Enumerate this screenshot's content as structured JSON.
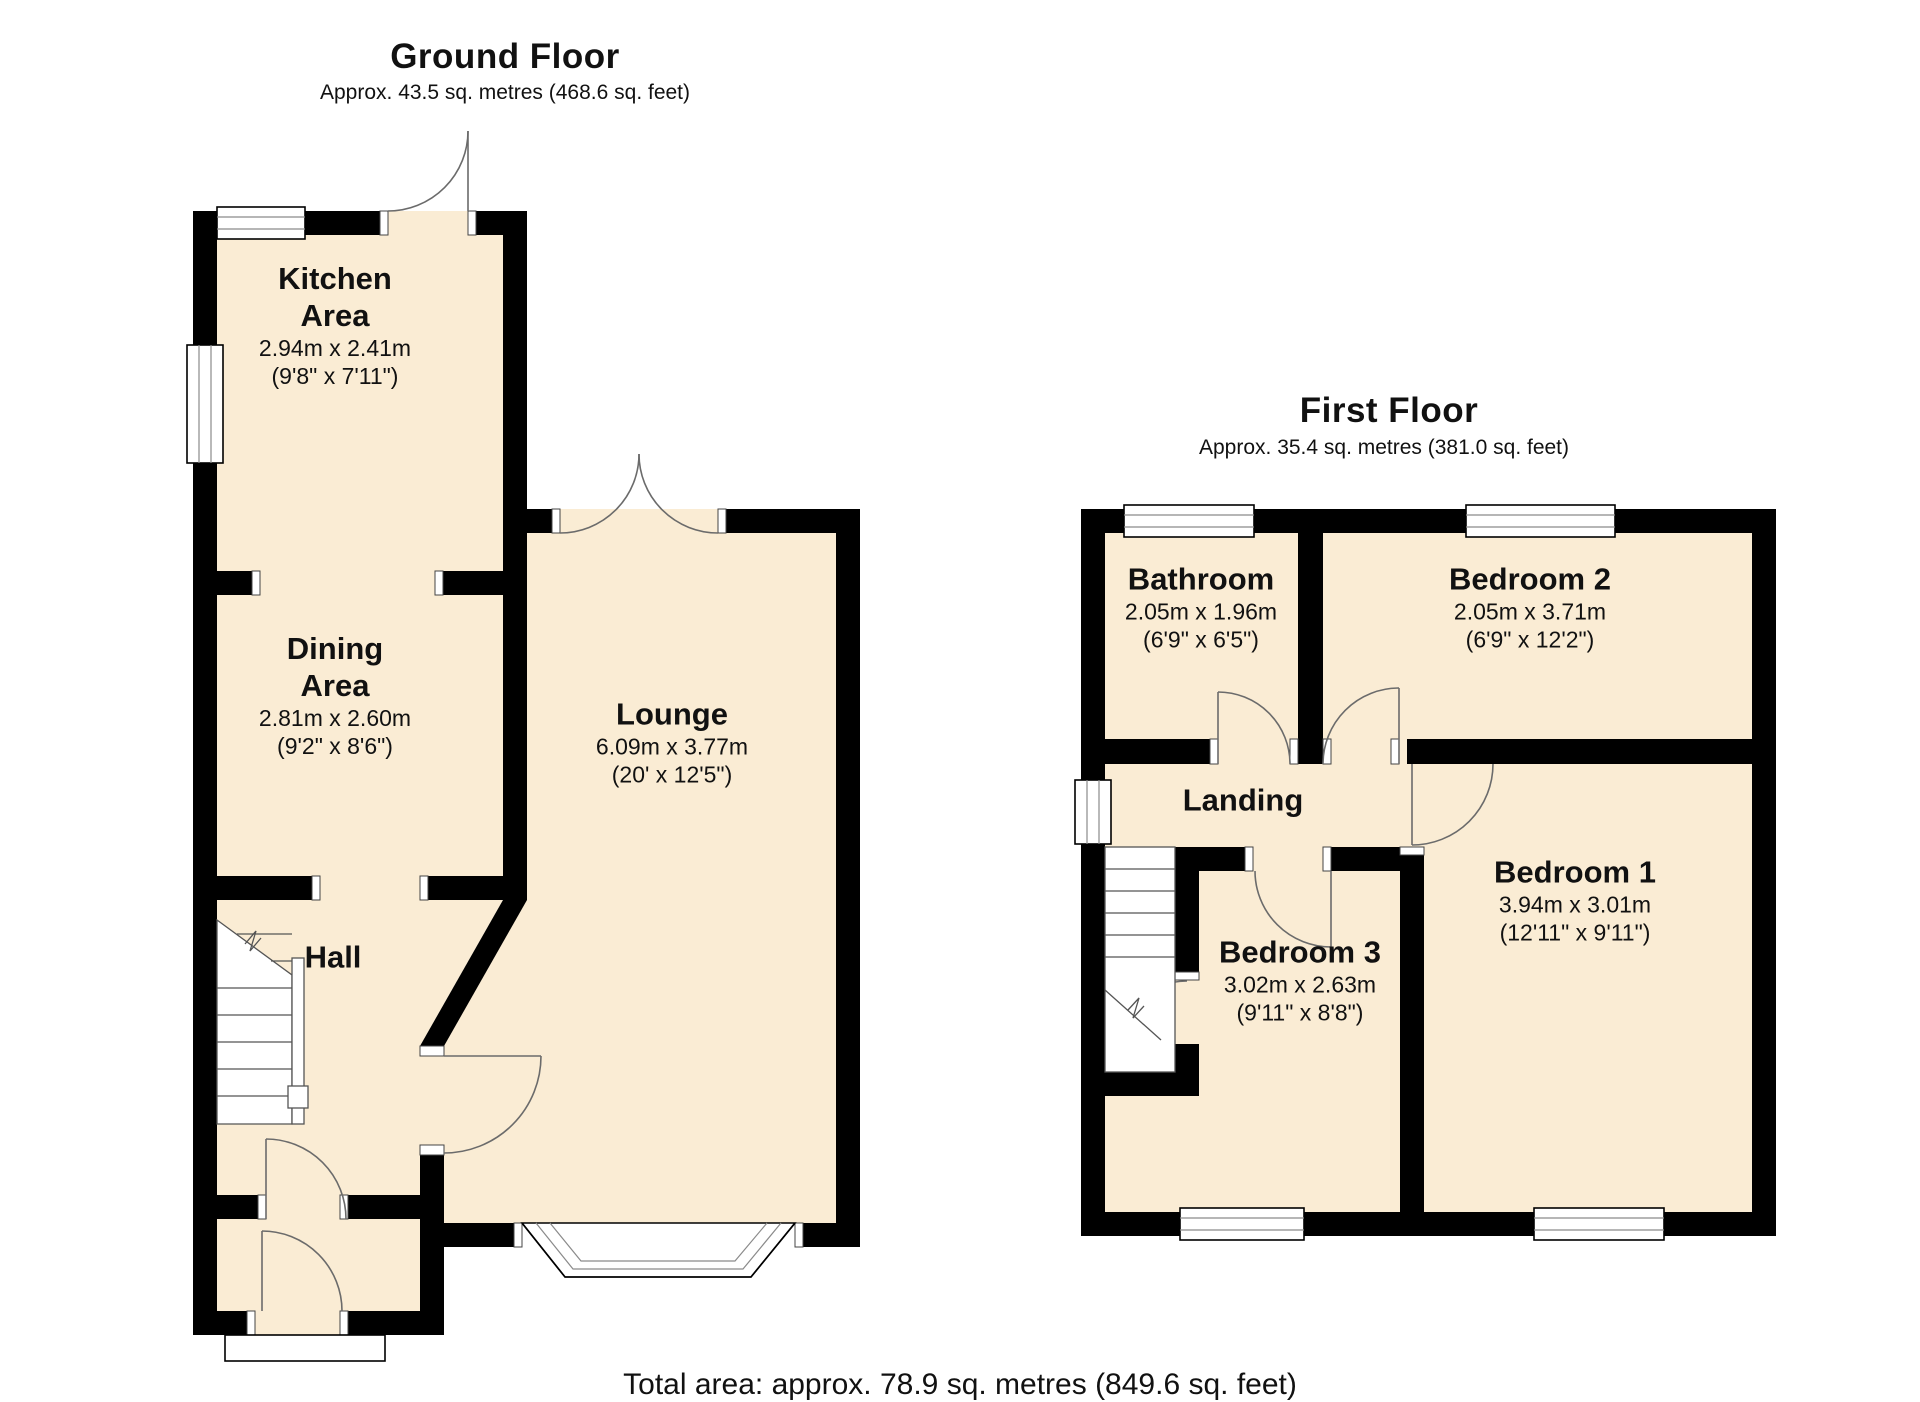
{
  "ground_floor": {
    "title": "Ground Floor",
    "subtitle": "Approx. 43.5 sq. metres (468.6 sq. feet)",
    "rooms": {
      "kitchen": {
        "name_line1": "Kitchen",
        "name_line2": "Area",
        "metric": "2.94m x 2.41m",
        "imperial": "(9'8\" x 7'11\")"
      },
      "dining": {
        "name_line1": "Dining",
        "name_line2": "Area",
        "metric": "2.81m x 2.60m",
        "imperial": "(9'2\" x 8'6\")"
      },
      "lounge": {
        "name": "Lounge",
        "metric": "6.09m x 3.77m",
        "imperial": "(20' x 12'5\")"
      },
      "hall": {
        "name": "Hall"
      }
    }
  },
  "first_floor": {
    "title": "First Floor",
    "subtitle": "Approx. 35.4 sq. metres (381.0 sq. feet)",
    "rooms": {
      "bathroom": {
        "name": "Bathroom",
        "metric": "2.05m x 1.96m",
        "imperial": "(6'9\" x 6'5\")"
      },
      "bedroom2": {
        "name": "Bedroom 2",
        "metric": "2.05m x 3.71m",
        "imperial": "(6'9\" x 12'2\")"
      },
      "landing": {
        "name": "Landing"
      },
      "bedroom1": {
        "name": "Bedroom 1",
        "metric": "3.94m x 3.01m",
        "imperial": "(12'11\" x 9'11\")"
      },
      "bedroom3": {
        "name": "Bedroom 3",
        "metric": "3.02m x 2.63m",
        "imperial": "(9'11\" x 8'8\")"
      }
    }
  },
  "footer": {
    "total_area": "Total area: approx. 78.9 sq. metres (849.6 sq. feet)"
  },
  "colors": {
    "floor_fill": "#faecd4",
    "wall": "#000000",
    "background": "#ffffff"
  }
}
